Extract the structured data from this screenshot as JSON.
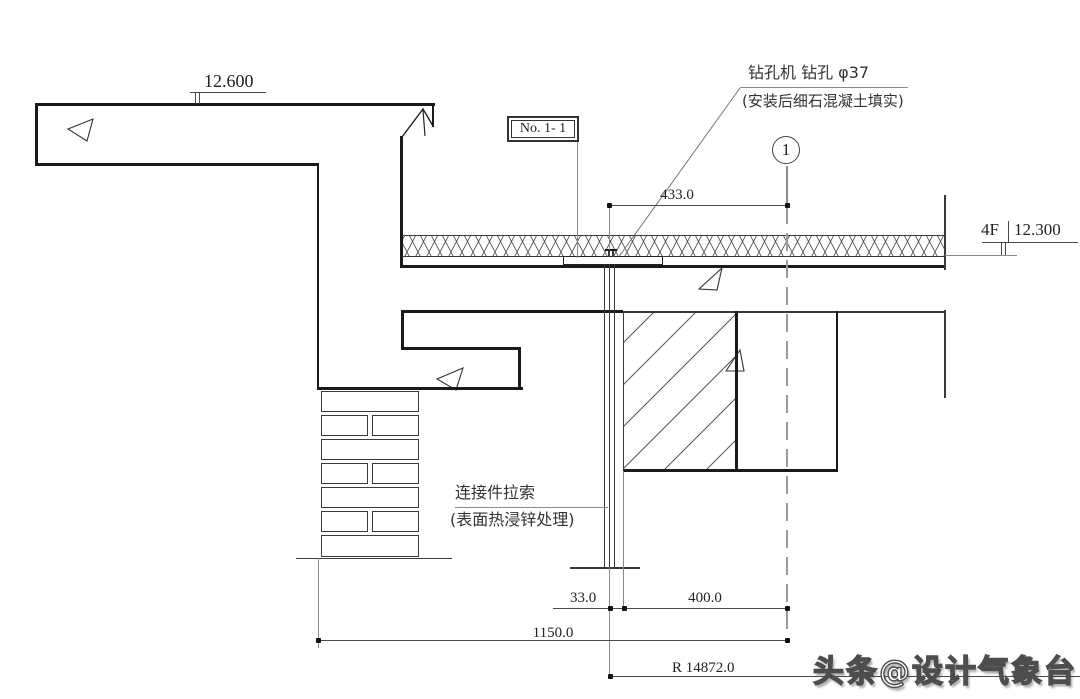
{
  "drawing": {
    "elevation_top": "12.600",
    "drill_note": {
      "line1": "钻孔机  钻孔 φ37",
      "line2": "(安装后细石混凝土填实)"
    },
    "detail_tag": "No. 1- 1",
    "axis_bubble": "1",
    "level_marker": {
      "floor": "4F",
      "value": "12.300"
    },
    "cable_note": {
      "line1": "连接件拉索",
      "line2": "(表面热浸锌处理)"
    },
    "dimensions": {
      "d433": "433.0",
      "d33": "33.0",
      "d400": "400.0",
      "d1150": "1150.0",
      "radius": "R 14872.0"
    },
    "colors": {
      "line_heavy": "#1a1a1a",
      "line_thin": "#3a3a3a",
      "line_extension": "#8a8a8a",
      "background": "#ffffff",
      "watermark_fill": "#ffffff",
      "watermark_outline": "#4d4d4d"
    }
  },
  "watermark": "头条@设计气象台"
}
